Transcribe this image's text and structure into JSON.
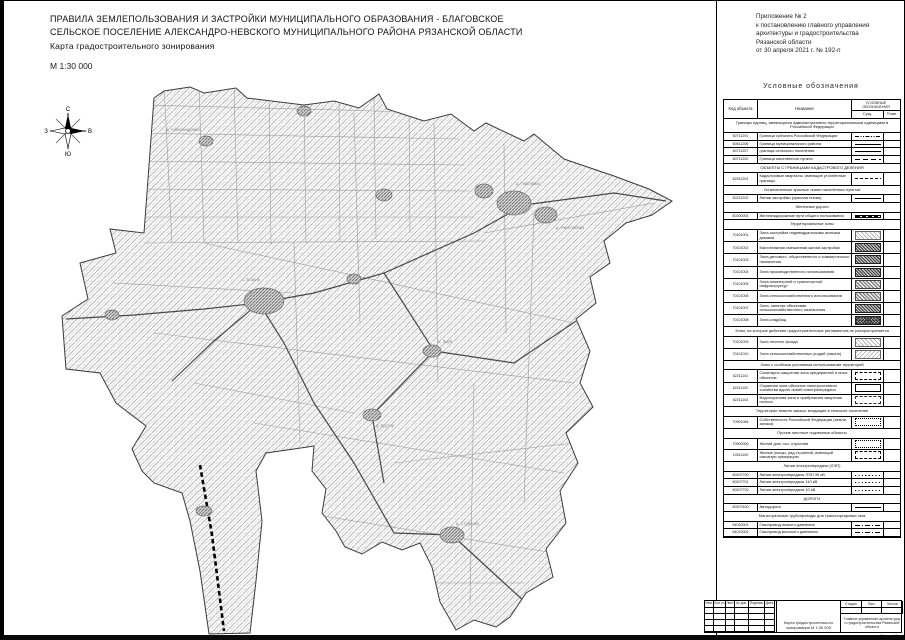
{
  "header": {
    "title_line1": "ПРАВИЛА ЗЕМЛЕПОЛЬЗОВАНИЯ И ЗАСТРОЙКИ МУНИЦИПАЛЬНОГО ОБРАЗОВАНИЯ - БЛАГОВСКОЕ",
    "title_line2": "СЕЛЬСКОЕ ПОСЕЛЕНИЕ АЛЕКСАНДРО-НЕВСКОГО МУНИЦИПАЛЬНОГО РАЙОНА РЯЗАНСКОЙ ОБЛАСТИ",
    "subtitle": "Карта градостроительного зонирования",
    "scale": "М 1:30 000"
  },
  "annex": {
    "lines": [
      "Приложение № 2",
      "к постановлению главного управления",
      "архитектуры и градостроительства",
      "Рязанской области",
      "от 30 апреля 2021 г. № 192-п"
    ]
  },
  "compass": {
    "north": "С",
    "south": "Ю",
    "west": "З",
    "east": "В"
  },
  "legend": {
    "title": "Условные  обозначения",
    "col_code": "Код объекта",
    "col_name": "Название",
    "col_symbols": "УСЛОВНЫЕ  ОБОЗНАЧЕНИЯ",
    "col_exist": "Сущ.",
    "col_plan": "План.",
    "items": [
      {
        "t": "sec",
        "text": "Границы единиц, являющихся административно-территориальными единицами в Российской Федерации"
      },
      {
        "t": "row",
        "code": "60711291",
        "name": "Граница субъекта Российской Федерации",
        "sw": "line-dashdotdot"
      },
      {
        "t": "row",
        "code": "60611206",
        "name": "Граница муниципального района",
        "sw": "line-bold"
      },
      {
        "t": "row",
        "code": "60711207",
        "name": "граница сельского поселения",
        "sw": "line-solid"
      },
      {
        "t": "row",
        "code": "60711202",
        "name": "Граница населённого пункта",
        "sw": "line-longdash"
      },
      {
        "t": "sec",
        "text": "ОБЪЕКТЫ С ГРАНИЦАМИ КАДАСТРОВОГО ДЕЛЕНИЯ"
      },
      {
        "t": "row",
        "code": "62511201",
        "name": "Кадастровые кварталы, имеющие уточнённые границы",
        "sw": "line-dash"
      },
      {
        "t": "sec",
        "text": "Установленные красные линии населённых пунктов"
      },
      {
        "t": "row",
        "code": "60211202",
        "name": "Линия застройки (красная линия)",
        "sw": "line-solid"
      },
      {
        "t": "sec",
        "text": "Железные дороги"
      },
      {
        "t": "row",
        "code": "60200001",
        "name": "Железнодорожные пути общего пользования",
        "sw": "rail"
      },
      {
        "t": "sec",
        "text": "Территориальные зоны"
      },
      {
        "t": "row",
        "code": "70101001",
        "name": "Зона застройки индивидуальными жилыми домами",
        "sw": "hatch-light"
      },
      {
        "t": "row",
        "code": "70101002",
        "name": "Малоэтажная смешанная жилая застройка",
        "sw": "hatch-dark"
      },
      {
        "t": "row",
        "code": "70101003",
        "name": "Зона делового, общественного и коммерческого назначения",
        "sw": "hatch-dark"
      },
      {
        "t": "row",
        "code": "70101004",
        "name": "Зона производственного использования",
        "sw": "hatch-dark"
      },
      {
        "t": "row",
        "code": "70101005",
        "name": "Зона инженерной и транспортной инфраструктур",
        "sw": "hatch-mid"
      },
      {
        "t": "row",
        "code": "70101006",
        "name": "Зона сельскохозяйственного использования",
        "sw": "hatch-mid"
      },
      {
        "t": "row",
        "code": "70101007",
        "name": "Зона, занятая объектами сельскохозяйственного назначения",
        "sw": "hatch-dark"
      },
      {
        "t": "row",
        "code": "70101008",
        "name": "Зона кладбищ",
        "sw": "hatch-cross"
      },
      {
        "t": "sec",
        "text": "Зоны, на которые действие градостроительных регламентов не распространяется"
      },
      {
        "t": "row",
        "code": "70101009",
        "name": "Зона лесного фонда",
        "sw": "hatch-light"
      },
      {
        "t": "row",
        "code": "70101010",
        "name": "Зона сельскохозяйственных угодий (пашни)",
        "sw": "hatch-light2"
      },
      {
        "t": "sec",
        "text": "Зоны с особыми условиями использования территорий"
      },
      {
        "t": "row",
        "code": "62211101",
        "name": "Санитарно-защитная зона предприятий и иных объектов",
        "sw": "rect-dash"
      },
      {
        "t": "row",
        "code": "62211102",
        "name": "Охранная зона объектов электросетевого хозяйства вдоль линий электропередачи",
        "sw": "rect-solid"
      },
      {
        "t": "row",
        "code": "62211103",
        "name": "Водоохранная зона и прибрежная защитная полоса",
        "sw": "rect-dashdot"
      },
      {
        "t": "sec",
        "text": "Территории земель запаса, входящие в сельское поселение"
      },
      {
        "t": "row",
        "code": "70901084",
        "name": "Собственность Российской Федерации (земли запаса)",
        "sw": "rect-dot"
      },
      {
        "t": "sec",
        "text": "Прочие местные подземные объекты"
      },
      {
        "t": "row",
        "code": "70900000",
        "name": "Жилой дом, хоз. строения",
        "sw": "rect-dot"
      },
      {
        "t": "row",
        "code": "10011100",
        "name": "Жилые улицы, ряд строений, имеющий сквозную нумерацию",
        "sw": "rect-dash"
      },
      {
        "t": "sec",
        "text": "Линии электропередачи (ЛЭП)"
      },
      {
        "t": "row",
        "code": "60207700",
        "name": "Линия электропередачи ЛЭП 35 кВ",
        "sw": "line-dot"
      },
      {
        "t": "row",
        "code": "60207701",
        "name": "Линия электропередачи 110 кВ",
        "sw": "line-dot"
      },
      {
        "t": "row",
        "code": "60207702",
        "name": "Линия электропередачи 10 кВ",
        "sw": "line-dot"
      },
      {
        "t": "sec",
        "text": "ДОРОГИ"
      },
      {
        "t": "row",
        "code": "60207400",
        "name": "Автодорога",
        "sw": "line-solid"
      },
      {
        "t": "sec",
        "text": "Магистральные трубопроводы для транспортировки газа"
      },
      {
        "t": "row",
        "code": "64010001",
        "name": "Газопровод низкого давления",
        "sw": "line-dashdot"
      },
      {
        "t": "row",
        "code": "64010002",
        "name": "Газопровод высокого давления",
        "sw": "line-dashdot"
      }
    ]
  },
  "map": {
    "labels": [
      {
        "text": "с. Благие",
        "x": 188,
        "y": 198
      },
      {
        "text": "д. Павловка",
        "x": 462,
        "y": 102
      },
      {
        "text": "д. Николаевка",
        "x": 502,
        "y": 146
      },
      {
        "text": "д. Александровка",
        "x": 112,
        "y": 48
      },
      {
        "text": "п. Заря",
        "x": 384,
        "y": 260
      },
      {
        "text": "д. Крутое",
        "x": 322,
        "y": 344
      },
      {
        "text": "д. Студёнки",
        "x": 402,
        "y": 442
      }
    ]
  },
  "titleblock": {
    "cols": [
      "Изм.",
      "Кол.уч",
      "Лист",
      "№ док.",
      "Подпись",
      "Дата"
    ],
    "doc_title": "Карта градостроительного зонирования М 1:30 000",
    "stage_label": "Стадия",
    "sheet_label": "Лист",
    "sheets_label": "Листов",
    "org": "Главное управление архитектуры и градостроительства Рязанской области",
    "format_note": "Формат А1"
  }
}
